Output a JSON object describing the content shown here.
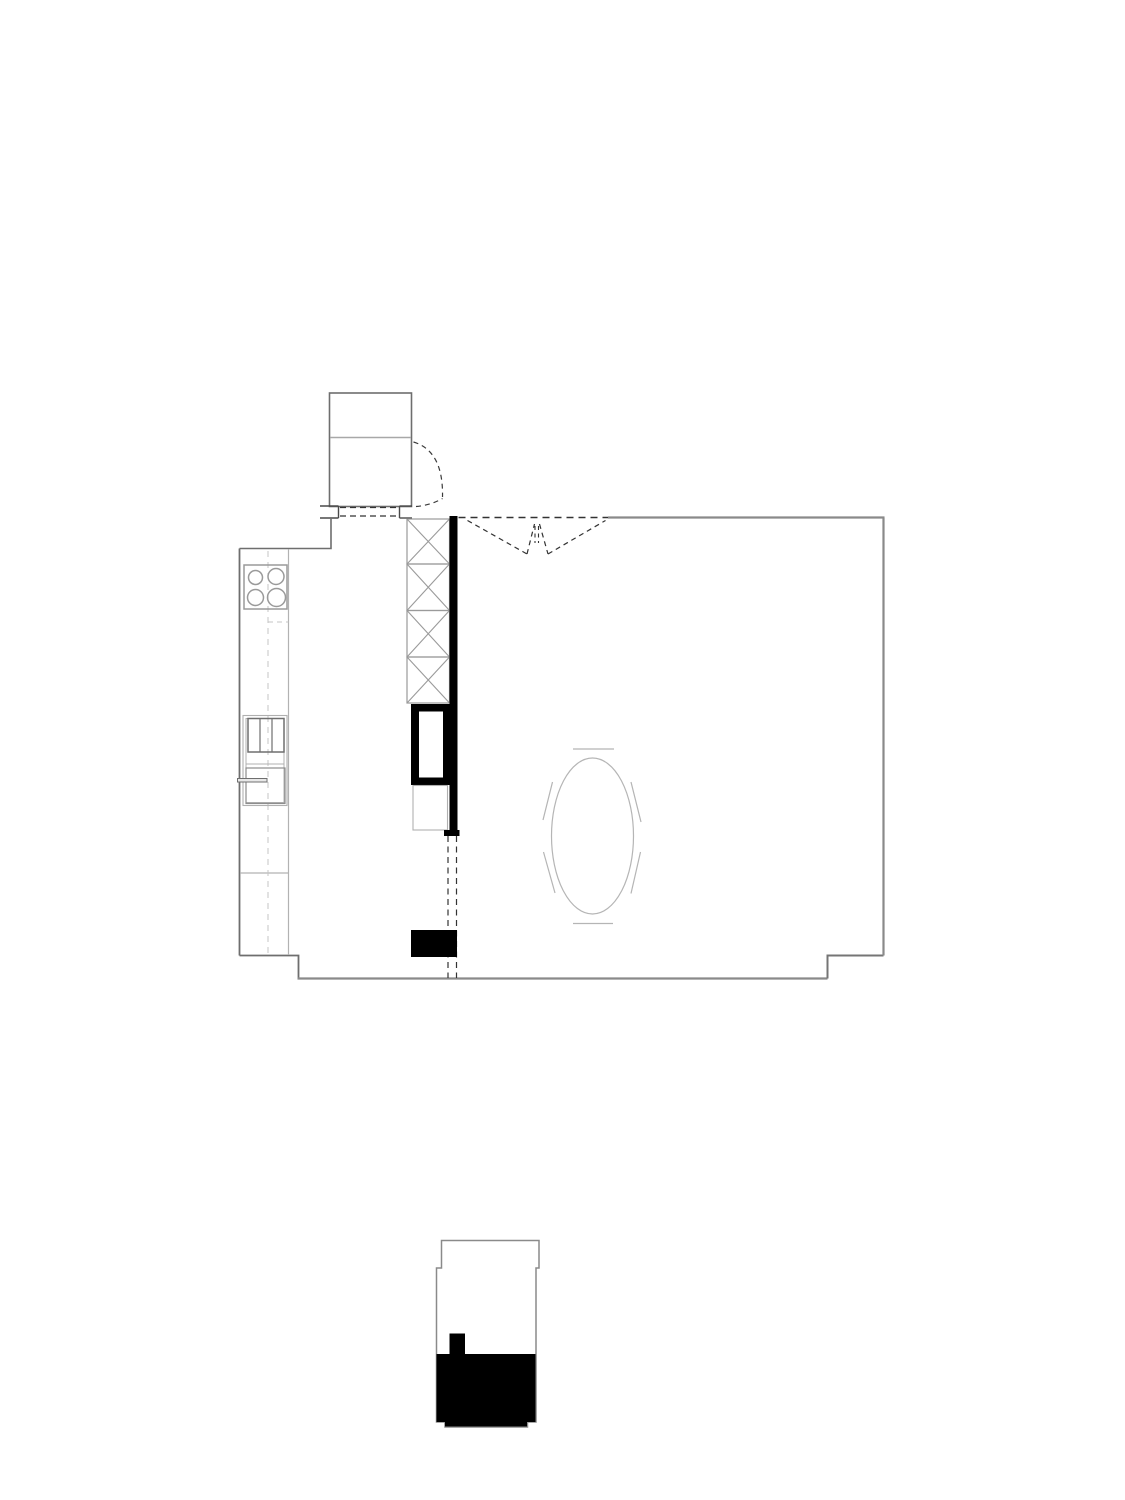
{
  "page": {
    "width": 1125,
    "height": 1500,
    "background": "#ffffff"
  },
  "palette": {
    "wall_gray": "#8a8a8a",
    "outline_gray": "#6e6e6e",
    "furniture_light_gray": "#b2b2b2",
    "detail_mid_gray": "#9a9a9a",
    "dash_dark": "#333333",
    "solid_black": "#000000",
    "paper_white": "#ffffff"
  },
  "drawing": {
    "figures": [
      "main-floor-plan",
      "key-plan"
    ],
    "shapes": [
      {
        "n": "closet-outline",
        "t": "rect",
        "p": [
          329.5,
          393,
          82,
          113.5
        ],
        "s": "#6e6e6e",
        "w": 1.6
      },
      {
        "n": "closet-shelf-line",
        "t": "line",
        "p": [
          330.5,
          437.5,
          411,
          437.5
        ],
        "s": "#a8a8a8",
        "w": 1.4
      },
      {
        "n": "closet-door-swing-arc",
        "t": "path",
        "p": "M413.5,442 Q443.5,451 442.5,497",
        "s": "#3a3a3a",
        "w": 1.2,
        "d": "5,4"
      },
      {
        "n": "closet-door-leaf",
        "t": "path",
        "p": "M416,506.5 Q430,505.5 442.5,498.5",
        "s": "#3a3a3a",
        "w": 1.2,
        "d": "5,4"
      },
      {
        "n": "entry-jamb-left-top-tick",
        "t": "line",
        "p": [
          320,
          506,
          338.5,
          506
        ],
        "s": "#4a4a4a",
        "w": 1.4
      },
      {
        "n": "entry-jamb-left-vertical",
        "t": "line",
        "p": [
          338.5,
          506,
          338.5,
          518
        ],
        "s": "#4a4a4a",
        "w": 1.4
      },
      {
        "n": "entry-jamb-left-bottom-tick",
        "t": "line",
        "p": [
          320,
          518,
          338.5,
          518
        ],
        "s": "#4a4a4a",
        "w": 1.4
      },
      {
        "n": "entry-jamb-right-vertical",
        "t": "line",
        "p": [
          399.5,
          506,
          399.5,
          518
        ],
        "s": "#4a4a4a",
        "w": 1.4
      },
      {
        "n": "entry-jamb-right-top-tick",
        "t": "line",
        "p": [
          399.5,
          506,
          412,
          506
        ],
        "s": "#4a4a4a",
        "w": 1.4
      },
      {
        "n": "entry-jamb-right-bottom-tick",
        "t": "line",
        "p": [
          399.5,
          518,
          412,
          518
        ],
        "s": "#4a4a4a",
        "w": 1.4
      },
      {
        "n": "entry-opening-dash-top",
        "t": "line",
        "p": [
          340,
          507.5,
          398,
          507.5
        ],
        "s": "#333333",
        "w": 1.2,
        "d": "6,4"
      },
      {
        "n": "entry-opening-dash-bottom",
        "t": "line",
        "p": [
          340,
          516,
          398,
          516
        ],
        "s": "#333333",
        "w": 1.2,
        "d": "6,4"
      },
      {
        "n": "wall-left-upper",
        "t": "polyline",
        "p": "331,518 331,548.5 239.5,548.5",
        "s": "#6e6e6e",
        "w": 1.6
      },
      {
        "n": "wall-left",
        "t": "line",
        "p": [
          239.5,
          548.5,
          239.5,
          955.5
        ],
        "s": "#6e6e6e",
        "w": 1.8
      },
      {
        "n": "wall-bottom-left-step",
        "t": "polyline",
        "p": "239.5,955.5 298.5,955.5 298.5,978.5",
        "s": "#6e6e6e",
        "w": 1.8
      },
      {
        "n": "wall-bottom",
        "t": "line",
        "p": [
          297.5,
          978.5,
          827.5,
          978.5
        ],
        "s": "#8a8a8a",
        "w": 2.2
      },
      {
        "n": "wall-bottom-right-step",
        "t": "polyline",
        "p": "827.5,978.5 827.5,955.5 883.5,955.5",
        "s": "#757575",
        "w": 2
      },
      {
        "n": "wall-right",
        "t": "line",
        "p": [
          883.5,
          955.5,
          883.5,
          517.5
        ],
        "s": "#8a8a8a",
        "w": 2.2
      },
      {
        "n": "wall-top",
        "t": "line",
        "p": [
          608,
          517.5,
          884.5,
          517.5
        ],
        "s": "#8a8a8a",
        "w": 2.2
      },
      {
        "n": "wall-top-opening-dash",
        "t": "line",
        "p": [
          458.5,
          517.5,
          608,
          517.5
        ],
        "s": "#333333",
        "w": 1.4,
        "d": "7,5"
      },
      {
        "n": "door-swing-left-chord",
        "t": "line",
        "p": [
          467.5,
          520.5,
          527,
          554
        ],
        "s": "#333333",
        "w": 1.2,
        "d": "5,4"
      },
      {
        "n": "door-swing-left-leaf",
        "t": "line",
        "p": [
          527,
          554,
          534.5,
          524
        ],
        "s": "#333333",
        "w": 1.2,
        "d": "5,4"
      },
      {
        "n": "door-swing-right-leaf",
        "t": "line",
        "p": [
          539.5,
          524,
          548,
          554
        ],
        "s": "#333333",
        "w": 1.2,
        "d": "5,4"
      },
      {
        "n": "door-swing-right-chord",
        "t": "line",
        "p": [
          548,
          554,
          605.5,
          520.5
        ],
        "s": "#333333",
        "w": 1.2,
        "d": "5,4"
      },
      {
        "n": "door-swing-center-dash-left",
        "t": "line",
        "p": [
          535,
          526,
          535,
          543
        ],
        "s": "#333333",
        "w": 1.1,
        "d": "4,3.5"
      },
      {
        "n": "door-swing-center-dash-right",
        "t": "line",
        "p": [
          538.5,
          526,
          538.5,
          543
        ],
        "s": "#333333",
        "w": 1.1,
        "d": "4,3.5"
      },
      {
        "n": "kitchen-counter-edge",
        "t": "line",
        "p": [
          288.5,
          549,
          288.5,
          955
        ],
        "s": "#b2b2b2",
        "w": 1.2
      },
      {
        "n": "kitchen-counter-divider",
        "t": "line",
        "p": [
          240,
          873,
          288.5,
          873
        ],
        "s": "#b2b2b2",
        "w": 1.2
      },
      {
        "n": "kitchen-centerline-dash",
        "t": "line",
        "p": [
          268,
          551,
          268,
          953
        ],
        "s": "#c4c4c4",
        "w": 1,
        "d": "6,5"
      },
      {
        "n": "kitchen-dash-tick",
        "t": "line",
        "p": [
          268,
          622,
          288.5,
          622
        ],
        "s": "#c4c4c4",
        "w": 1,
        "d": "5,4"
      },
      {
        "n": "cooktop-outline",
        "t": "rect",
        "p": [
          244,
          565,
          43,
          44
        ],
        "s": "#9a9a9a",
        "w": 1.5
      },
      {
        "n": "cooktop-burner-top-left",
        "t": "circle",
        "p": [
          255.5,
          577.5,
          7
        ],
        "s": "#9a9a9a",
        "w": 1.5
      },
      {
        "n": "cooktop-burner-top-right",
        "t": "circle",
        "p": [
          276,
          576.5,
          8
        ],
        "s": "#9a9a9a",
        "w": 1.5
      },
      {
        "n": "cooktop-burner-bottom-left",
        "t": "circle",
        "p": [
          255.5,
          597.5,
          8
        ],
        "s": "#9a9a9a",
        "w": 1.5
      },
      {
        "n": "cooktop-burner-bottom-right",
        "t": "circle",
        "p": [
          276.5,
          597.5,
          9
        ],
        "s": "#9a9a9a",
        "w": 1.5
      },
      {
        "n": "sink-unit-outer",
        "t": "rect",
        "p": [
          243,
          715.5,
          44,
          90
        ],
        "s": "#b0b0b0",
        "w": 1.1
      },
      {
        "n": "sink-unit-inner",
        "t": "rect",
        "p": [
          246,
          718.5,
          38,
          84
        ],
        "s": "#b0b0b0",
        "w": 1
      },
      {
        "n": "drawer-unit-outline",
        "t": "rect",
        "p": [
          248,
          718.5,
          36,
          33.5
        ],
        "s": "#6f6f6f",
        "w": 1.5
      },
      {
        "n": "drawer-divider-left",
        "t": "line",
        "p": [
          260,
          718.5,
          260,
          752
        ],
        "s": "#6f6f6f",
        "w": 1.2
      },
      {
        "n": "drawer-divider-right",
        "t": "line",
        "p": [
          272,
          718.5,
          272,
          752
        ],
        "s": "#6f6f6f",
        "w": 1.2
      },
      {
        "n": "sink-unit-middle-line",
        "t": "line",
        "p": [
          246,
          764,
          284,
          764
        ],
        "s": "#b0b0b0",
        "w": 1.1
      },
      {
        "n": "oven-unit-outline",
        "t": "rect",
        "p": [
          246,
          768,
          39,
          35.5
        ],
        "s": "#8d8d8d",
        "w": 1.2
      },
      {
        "n": "oven-handle",
        "t": "rect",
        "p": [
          237.5,
          778.5,
          29.5,
          3.5
        ],
        "s": "#6f6f6f",
        "w": 1,
        "f": "#e8e8e8"
      },
      {
        "n": "wardrobe-box-1",
        "t": "rect",
        "p": [
          407,
          519,
          42.5,
          45
        ],
        "s": "#9a9a9a",
        "w": 1.2
      },
      {
        "n": "wardrobe-box-1-cross-a",
        "t": "line",
        "p": [
          407,
          519,
          449.5,
          564
        ],
        "s": "#9a9a9a",
        "w": 1.1
      },
      {
        "n": "wardrobe-box-1-cross-b",
        "t": "line",
        "p": [
          449.5,
          519,
          407,
          564
        ],
        "s": "#9a9a9a",
        "w": 1.1
      },
      {
        "n": "wardrobe-box-2",
        "t": "rect",
        "p": [
          407,
          564,
          42.5,
          46.5
        ],
        "s": "#9a9a9a",
        "w": 1.2
      },
      {
        "n": "wardrobe-box-2-cross-a",
        "t": "line",
        "p": [
          407,
          564,
          449.5,
          610.5
        ],
        "s": "#9a9a9a",
        "w": 1.1
      },
      {
        "n": "wardrobe-box-2-cross-b",
        "t": "line",
        "p": [
          449.5,
          564,
          407,
          610.5
        ],
        "s": "#9a9a9a",
        "w": 1.1
      },
      {
        "n": "wardrobe-box-3",
        "t": "rect",
        "p": [
          407,
          610.5,
          42.5,
          46.5
        ],
        "s": "#9a9a9a",
        "w": 1.2
      },
      {
        "n": "wardrobe-box-3-cross-a",
        "t": "line",
        "p": [
          407,
          610.5,
          449.5,
          657
        ],
        "s": "#9a9a9a",
        "w": 1.1
      },
      {
        "n": "wardrobe-box-3-cross-b",
        "t": "line",
        "p": [
          449.5,
          610.5,
          407,
          657
        ],
        "s": "#9a9a9a",
        "w": 1.1
      },
      {
        "n": "wardrobe-box-4",
        "t": "rect",
        "p": [
          407,
          657,
          42.5,
          46
        ],
        "s": "#9a9a9a",
        "w": 1.2
      },
      {
        "n": "wardrobe-box-4-cross-a",
        "t": "line",
        "p": [
          407,
          657,
          449.5,
          703
        ],
        "s": "#9a9a9a",
        "w": 1.1
      },
      {
        "n": "wardrobe-box-4-cross-b",
        "t": "line",
        "p": [
          449.5,
          657,
          407,
          703
        ],
        "s": "#9a9a9a",
        "w": 1.1
      },
      {
        "n": "partition-wall-poche",
        "t": "rect",
        "p": [
          449.5,
          516,
          8,
          317
        ],
        "f": "#000000"
      },
      {
        "n": "stair-block-outer",
        "t": "rect",
        "p": [
          411,
          704,
          44,
          81
        ],
        "f": "#000000"
      },
      {
        "n": "stair-block-inner",
        "t": "rect",
        "p": [
          419,
          711.5,
          24,
          66
        ],
        "f": "#ffffff"
      },
      {
        "n": "cabinet-below-stair",
        "t": "rect",
        "p": [
          413,
          785.5,
          34.5,
          44.5
        ],
        "s": "#b0b0b0",
        "w": 1.1
      },
      {
        "n": "wall-end-foot",
        "t": "rect",
        "p": [
          444,
          830,
          15.5,
          6
        ],
        "f": "#000000"
      },
      {
        "n": "opening-dash-left",
        "t": "line",
        "p": [
          448,
          836,
          448,
          978
        ],
        "s": "#333333",
        "w": 1.2,
        "d": "6,4.5"
      },
      {
        "n": "opening-dash-right",
        "t": "line",
        "p": [
          456.5,
          836,
          456.5,
          978
        ],
        "s": "#333333",
        "w": 1.2,
        "d": "6,4.5"
      },
      {
        "n": "island-block",
        "t": "rect",
        "p": [
          411,
          930,
          46,
          27
        ],
        "f": "#000000"
      },
      {
        "n": "dining-table-ellipse",
        "t": "ellipse",
        "p": [
          592.5,
          836,
          41,
          78
        ],
        "s": "#b5b5b5",
        "w": 1.2
      },
      {
        "n": "chair-mark-top",
        "t": "line",
        "p": [
          573,
          749,
          614,
          749
        ],
        "s": "#b5b5b5",
        "w": 1.2
      },
      {
        "n": "chair-mark-bottom",
        "t": "line",
        "p": [
          573,
          923.5,
          613,
          923.5
        ],
        "s": "#b5b5b5",
        "w": 1.2
      },
      {
        "n": "chair-mark-left-upper",
        "t": "line",
        "p": [
          552.5,
          782,
          543,
          820
        ],
        "s": "#b5b5b5",
        "w": 1.2
      },
      {
        "n": "chair-mark-left-lower",
        "t": "line",
        "p": [
          543.5,
          852,
          555,
          893
        ],
        "s": "#b5b5b5",
        "w": 1.2
      },
      {
        "n": "chair-mark-right-upper",
        "t": "line",
        "p": [
          631,
          782,
          641,
          822
        ],
        "s": "#b5b5b5",
        "w": 1.2
      },
      {
        "n": "chair-mark-right-lower",
        "t": "line",
        "p": [
          640.5,
          852,
          631,
          893.5
        ],
        "s": "#b5b5b5",
        "w": 1.2
      },
      {
        "n": "keyplan-outline",
        "t": "path",
        "p": "M441.5,1240.5 L539,1240.5 L539,1268 L536,1268 L536,1422 L527.5,1422 L527.5,1427 L445,1427 L445,1422 L436.5,1422 L436.5,1268 L441.5,1268 Z",
        "s": "#8a8a8a",
        "w": 1.5
      },
      {
        "n": "keyplan-filled-area",
        "t": "path",
        "p": "M436.5,1354 L449.5,1354 L449.5,1333.5 L465,1333.5 L465,1354 L535.5,1354 L535.5,1422 L527,1422 L527,1426.5 L445,1426.5 L445,1422 L436.5,1422 Z",
        "f": "#000000"
      }
    ]
  }
}
